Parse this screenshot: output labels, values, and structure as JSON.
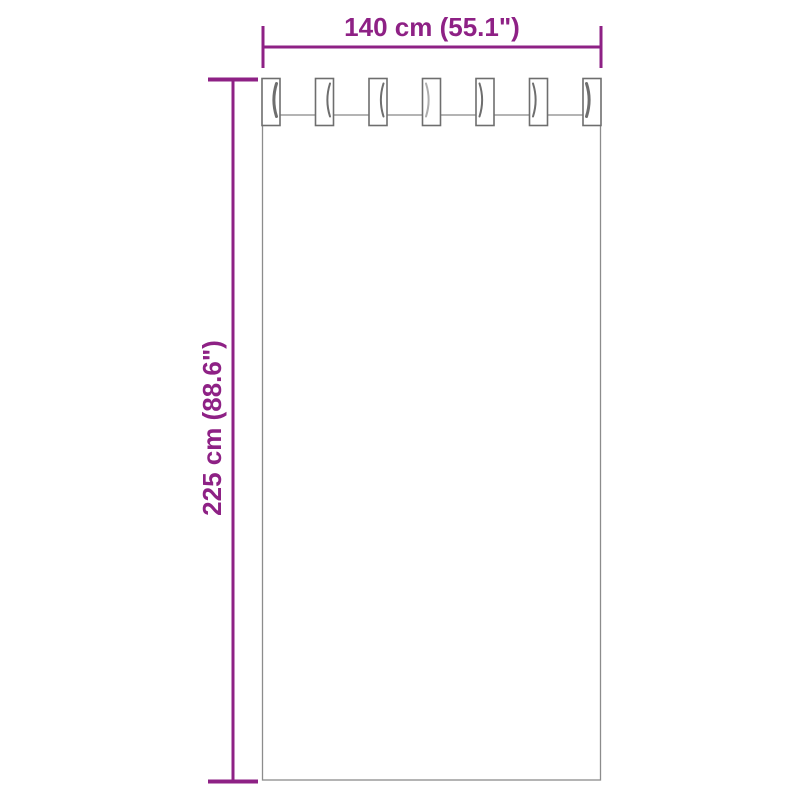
{
  "colors": {
    "accent": "#8E2185",
    "outline": "#8C8C8C",
    "shade": "#4A4A4A"
  },
  "dimensions": {
    "width_label": "140 cm (55.1\")",
    "height_label": "225 cm (88.6\")"
  },
  "curtain": {
    "tab_count": 7
  }
}
